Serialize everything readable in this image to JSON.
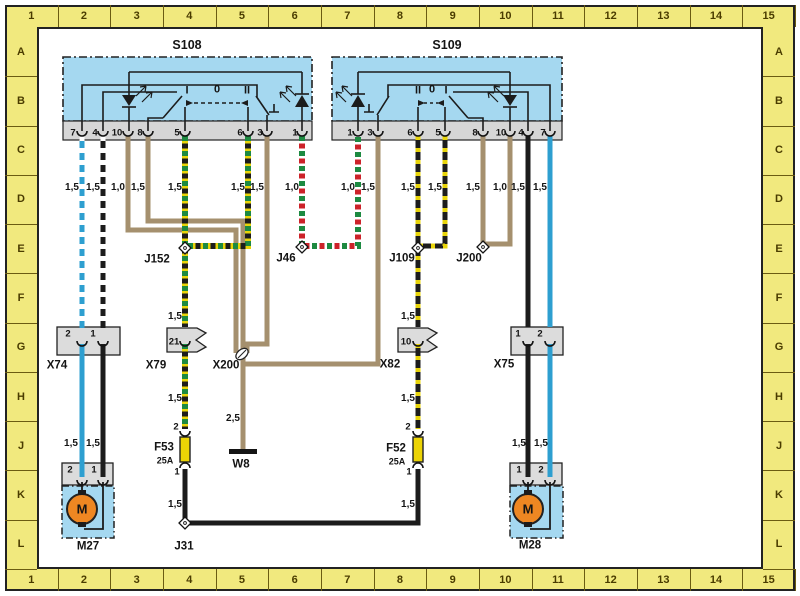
{
  "ruler": {
    "top": [
      "1",
      "2",
      "3",
      "4",
      "5",
      "6",
      "7",
      "8",
      "9",
      "10",
      "11",
      "12",
      "13",
      "14",
      "15"
    ],
    "bottom": [
      "1",
      "2",
      "3",
      "4",
      "5",
      "6",
      "7",
      "8",
      "9",
      "10",
      "11",
      "12",
      "13",
      "14",
      "15"
    ],
    "left": [
      "A",
      "B",
      "C",
      "D",
      "E",
      "F",
      "G",
      "H",
      "J",
      "K",
      "L"
    ],
    "right": [
      "A",
      "B",
      "C",
      "D",
      "E",
      "F",
      "G",
      "H",
      "J",
      "K",
      "L"
    ],
    "band_color": "#f1e97e",
    "text_color": "#4a3c00"
  },
  "components": {
    "s108": {
      "label": "S108",
      "terminals": [
        "7",
        "4",
        "10",
        "8",
        "5",
        "6",
        "3",
        "1"
      ],
      "positions": [
        "I",
        "0",
        "II"
      ]
    },
    "s109": {
      "label": "S109",
      "terminals": [
        "1",
        "3",
        "6",
        "5",
        "8",
        "10",
        "4",
        "7"
      ],
      "positions": [
        "II",
        "0",
        "I"
      ]
    },
    "x74": {
      "label": "X74",
      "pins": [
        "2",
        "1"
      ]
    },
    "x79": {
      "label": "X79",
      "pin": "21"
    },
    "x200": {
      "label": "X200"
    },
    "x82": {
      "label": "X82",
      "pin": "10"
    },
    "x75": {
      "label": "X75",
      "pins": [
        "1",
        "2"
      ]
    },
    "j152": "J152",
    "j46": "J46",
    "j109": "J109",
    "j200": "J200",
    "j31": "J31",
    "f53": {
      "label": "F53",
      "rating": "25A",
      "pin_top": "2",
      "pin_bottom": "1"
    },
    "f52": {
      "label": "F52",
      "rating": "25A",
      "pin_top": "2",
      "pin_bottom": "1"
    },
    "w8": "W8",
    "m27": {
      "label": "M27",
      "symbol": "M",
      "pins": [
        "2",
        "1"
      ]
    },
    "m28": {
      "label": "M28",
      "symbol": "M",
      "pins": [
        "1",
        "2"
      ]
    }
  },
  "gauges": {
    "s108": [
      "1,5",
      "1,5",
      "1,0",
      "1,5",
      "1,5",
      "1,5",
      "1,5",
      "1,0"
    ],
    "s109": [
      "1,0",
      "1,5",
      "1,5",
      "1,5",
      "1,5",
      "1,0",
      "1,5",
      "1,5"
    ],
    "x79_above": "1,5",
    "x79_below": "1,5",
    "below_f53": "1,5",
    "x82_above": "1,5",
    "x82_below": "1,5",
    "below_f52": "1,5",
    "ground": "2,5",
    "m27": [
      "1,5",
      "1,5"
    ],
    "m28": [
      "1,5",
      "1,5"
    ]
  },
  "colors": {
    "wire_blue": "#2e9fd0",
    "wire_black": "#1c1c1c",
    "wire_brown": "#a5906e",
    "stripe_white": "#ffffff",
    "stripe_yellow": "#e8d40a",
    "stripe_green": "#1d8a41",
    "stripe_red": "#cc2229",
    "fuse_yellow": "#ecd405",
    "motor_orange": "#ee8722",
    "switch_blue": "#a5d8f0",
    "panel_gray": "#d6d6d6",
    "ruler_yellow": "#f1e97e"
  }
}
